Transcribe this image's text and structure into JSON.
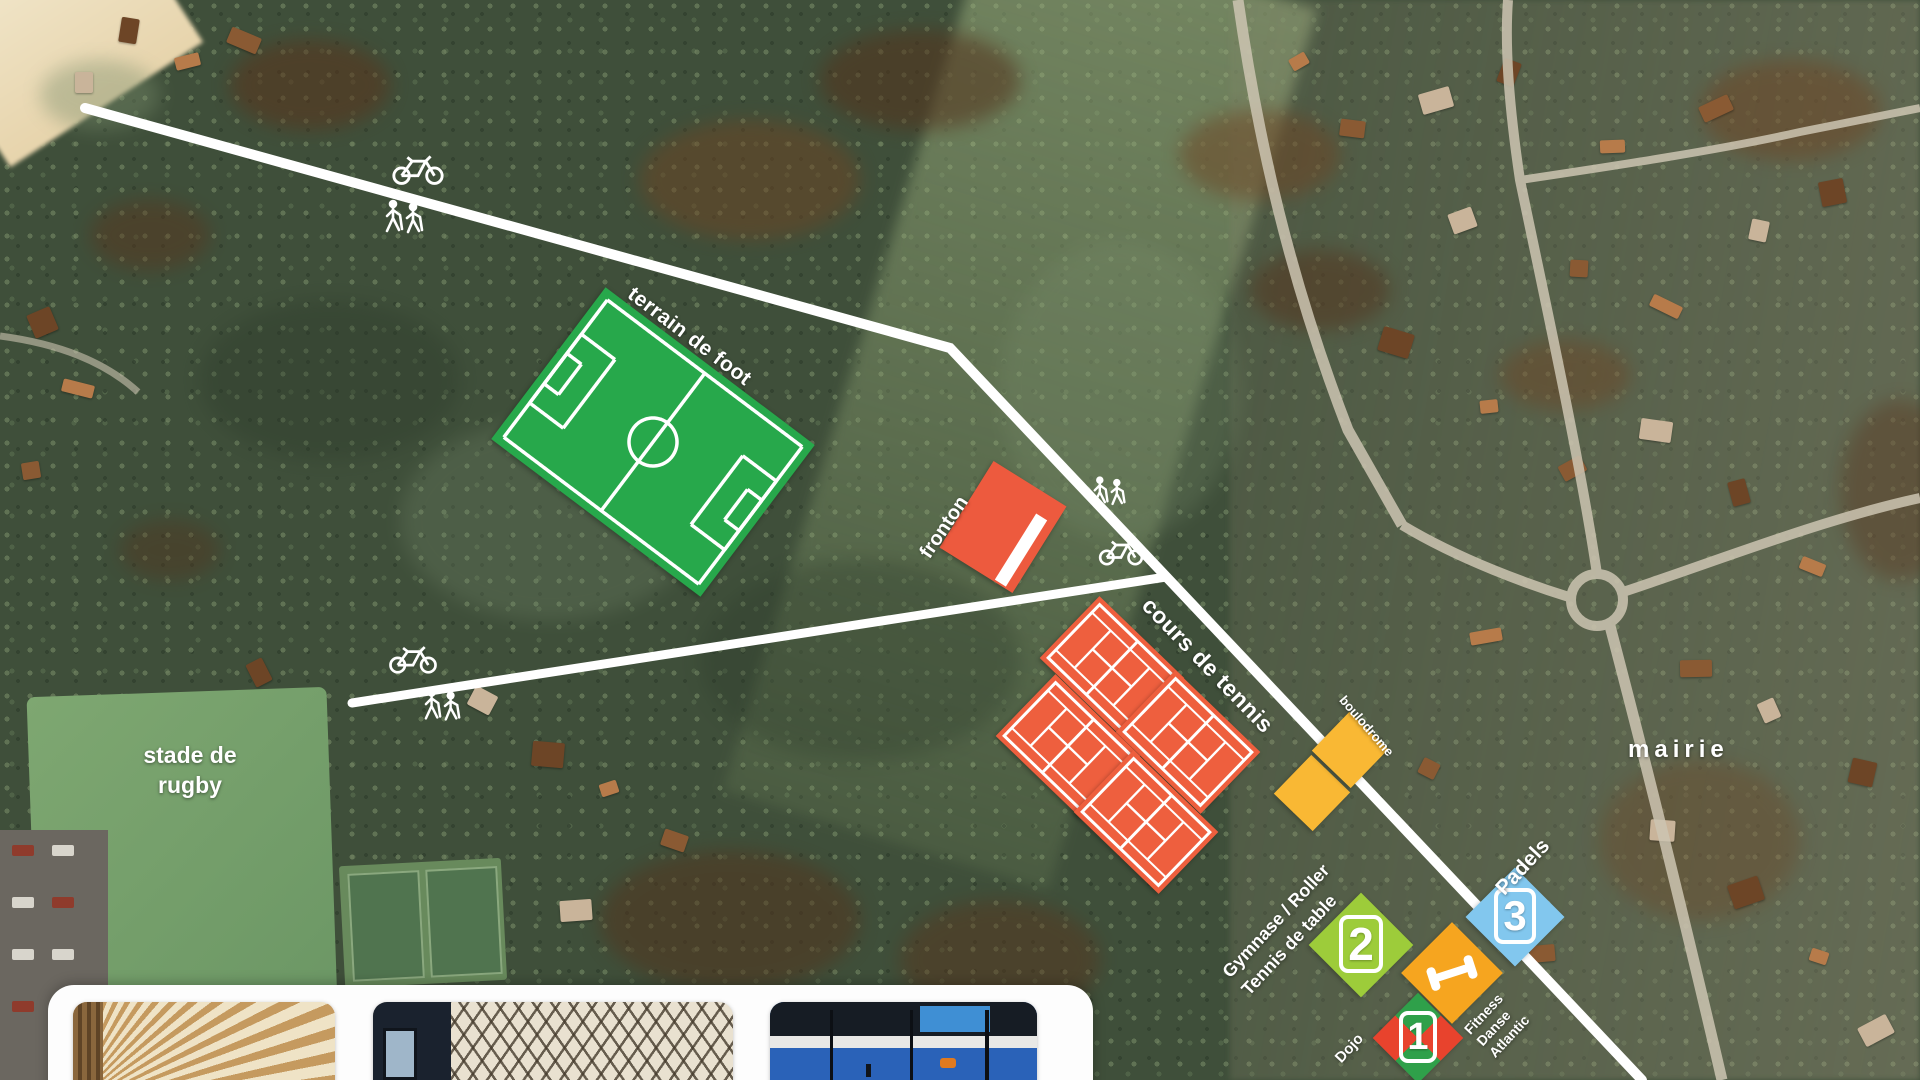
{
  "map": {
    "labels": {
      "football": "terrain de foot",
      "fronton": "fronton",
      "tennis": "cours de tennis",
      "boulodrome": "boulodrome",
      "rugby_line1": "stade de",
      "rugby_line2": "rugby",
      "mairie": "mairie",
      "padels": "Padels",
      "gymnase": "Gymnase / Roller",
      "table_tennis": "Tennis de table",
      "fitness_line1": "Fitness",
      "fitness_line2": "Danse",
      "fitness_line3": "Atlantic",
      "dojo": "Dojo"
    },
    "markers": [
      {
        "number": "1",
        "colors": [
          "#e8432d",
          "#2fa04a"
        ]
      },
      {
        "number": "2",
        "color": "#9dcc3a"
      },
      {
        "number": "3",
        "color": "#82c7ee"
      }
    ],
    "icons": [
      "bicycle-icon",
      "hikers-icon",
      "dumbbell-icon"
    ],
    "colors": {
      "football_green": "#27a84b",
      "court_red": "#ee5f3e",
      "fronton_red": "#ed5a3e",
      "boulodrome_yellow": "#f9b834",
      "gym_green": "#9dcc3a",
      "fitness_orange": "#f6a51f",
      "padel_blue": "#82c7ee",
      "path_white": "#ffffff"
    }
  },
  "photo_panel": {
    "photos": [
      "wood-hall-photo",
      "lattice-gym-photo",
      "padel-court-photo"
    ]
  }
}
